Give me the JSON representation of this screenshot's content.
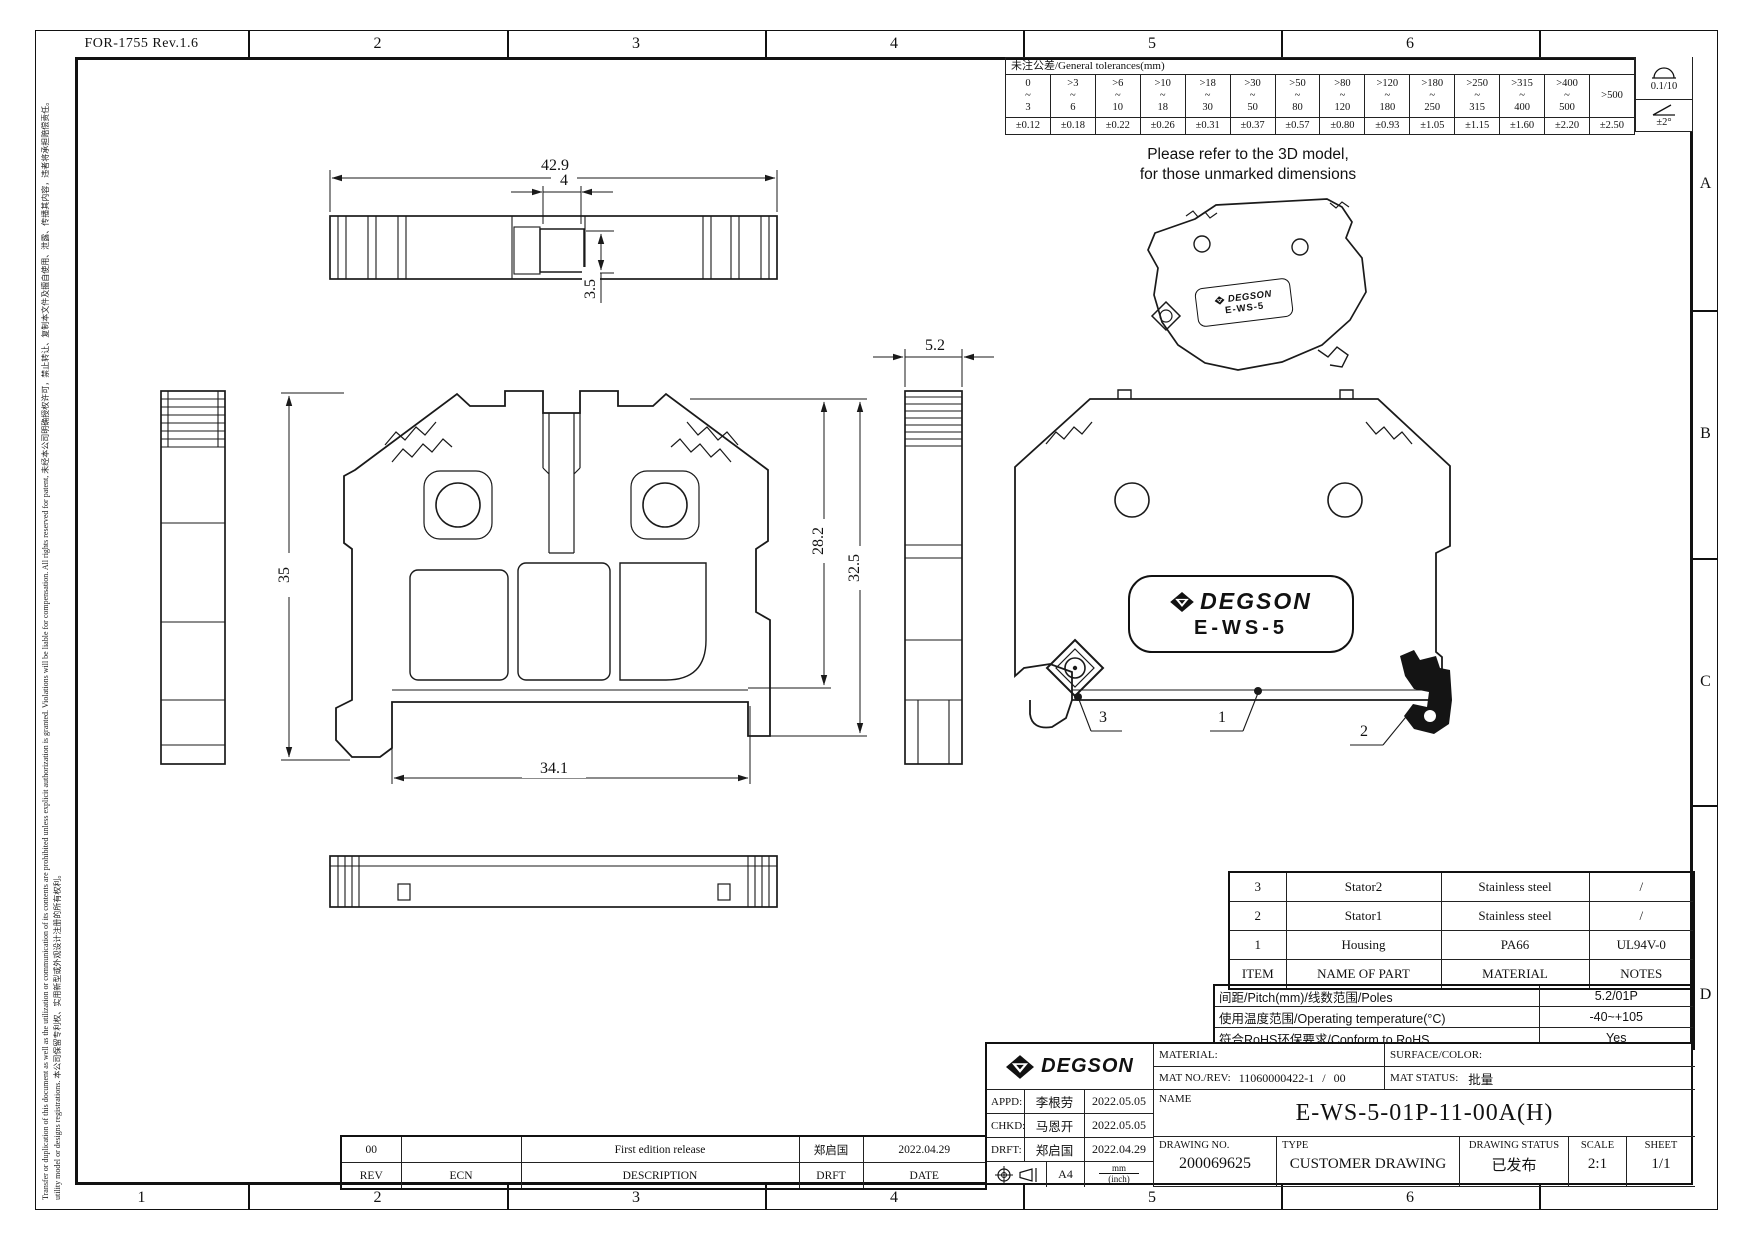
{
  "form_no": "FOR-1755 Rev.1.6",
  "zones": {
    "top": [
      "2",
      "3",
      "4",
      "5",
      "6"
    ],
    "bottom": [
      "1",
      "2",
      "3",
      "4",
      "5",
      "6"
    ],
    "right": [
      "A",
      "B",
      "C",
      "D"
    ]
  },
  "legal": {
    "line1": "Transfer or duplication of this document as well as the utilization or communication of its contents are prohibited unless explicit authorization is granted. Violations will be liable for compensation. All rights reserved for patent, 未经本公司明确授权许可，禁止转让、复制本文件及擅自使用、泄露、传播其内容，违者将承担赔偿责任。",
    "line2": "utility model or designs registrations. 本公司保留专利权、实用新型或外观设计注册的所有权利。"
  },
  "tolerances": {
    "title": "未注公差/General tolerances(mm)",
    "ranges": [
      "0\n~\n3",
      ">3\n~\n6",
      ">6\n~\n10",
      ">10\n~\n18",
      ">18\n~\n30",
      ">30\n~\n50",
      ">50\n~\n80",
      ">80\n~\n120",
      ">120\n~\n180",
      ">180\n~\n250",
      ">250\n~\n315",
      ">315\n~\n400",
      ">400\n~\n500",
      ">500"
    ],
    "values": [
      "±0.12",
      "±0.18",
      "±0.22",
      "±0.26",
      "±0.31",
      "±0.37",
      "±0.57",
      "±0.80",
      "±0.93",
      "±1.05",
      "±1.15",
      "±1.60",
      "±2.20",
      "±2.50"
    ],
    "flatness": "0.1/10",
    "angle": "±2°"
  },
  "note": {
    "line1": "Please refer to the 3D model,",
    "line2": "for those unmarked dimensions"
  },
  "dims": {
    "top_width": "42.9",
    "slot_width": "4",
    "slot_depth": "3.5",
    "height": "35",
    "body_height": "28.2",
    "overall_height": "32.5",
    "base_width": "34.1",
    "thickness": "5.2"
  },
  "callouts": [
    "1",
    "2",
    "3"
  ],
  "brand": "DEGSON",
  "model": "E-WS-5",
  "parts_table": {
    "headers": [
      "ITEM",
      "NAME OF PART",
      "MATERIAL",
      "NOTES"
    ],
    "rows": [
      {
        "item": "3",
        "name": "Stator2",
        "material": "Stainless steel",
        "notes": "/"
      },
      {
        "item": "2",
        "name": "Stator1",
        "material": "Stainless steel",
        "notes": "/"
      },
      {
        "item": "1",
        "name": "Housing",
        "material": "PA66",
        "notes": "UL94V-0"
      }
    ]
  },
  "spec_table": {
    "rows": [
      {
        "label": "间距/Pitch(mm)/线数范围/Poles",
        "value": "5.2/01P"
      },
      {
        "label": "使用温度范围/Operating temperature(°C)",
        "value": "-40~+105"
      },
      {
        "label": "符合RoHS环保要求/Conform to RoHS",
        "value": "Yes"
      }
    ]
  },
  "title_block": {
    "material_label": "MATERIAL:",
    "surface_label": "SURFACE/COLOR:",
    "mat_no_label": "MAT NO./REV:",
    "mat_no": "11060000422-1",
    "rev_sep": "/",
    "mat_rev": "00",
    "mat_status_label": "MAT STATUS:",
    "mat_status": "批量",
    "name_label": "NAME",
    "part_name": "E-WS-5-01P-11-00A(H)",
    "appd_label": "APPD:",
    "appd_name": "李根劳",
    "appd_date": "2022.05.05",
    "chkd_label": "CHKD:",
    "chkd_name": "马恩开",
    "chkd_date": "2022.05.05",
    "drft_label": "DRFT:",
    "drft_name": "郑启国",
    "drft_date": "2022.04.29",
    "paper_size": "A4",
    "units_top": "mm",
    "units_bottom": "(inch)",
    "drawing_no_label": "DRAWING NO.",
    "drawing_no": "200069625",
    "type_label": "TYPE",
    "type_value": "CUSTOMER DRAWING",
    "status_label": "DRAWING STATUS",
    "status_value": "已发布",
    "scale_label": "SCALE",
    "scale_value": "2:1",
    "sheet_label": "SHEET",
    "sheet_value": "1/1"
  },
  "revision": {
    "rev": "00",
    "ecn": "",
    "description": "First edition release",
    "drft": "郑启国",
    "date": "2022.04.29",
    "headers": {
      "rev": "REV",
      "ecn": "ECN",
      "description": "DESCRIPTION",
      "drft": "DRFT",
      "date": "DATE"
    }
  }
}
